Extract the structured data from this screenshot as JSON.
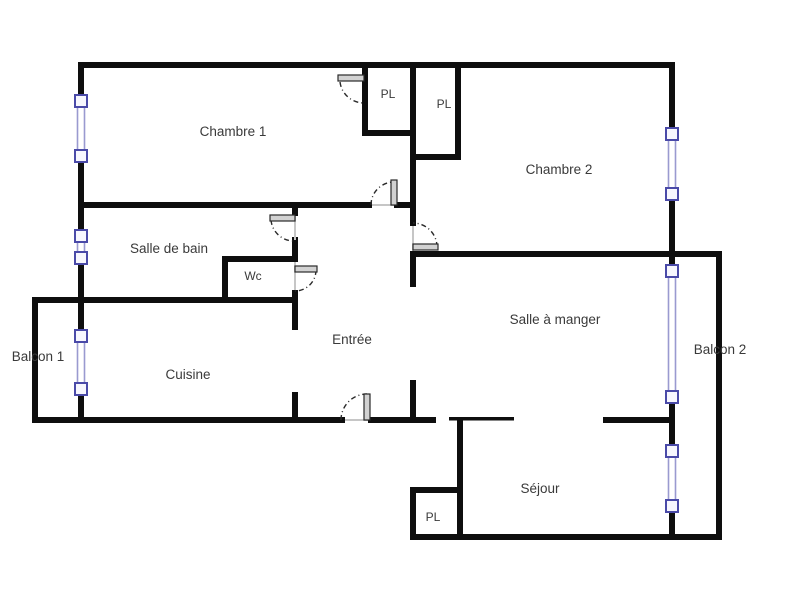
{
  "plan": {
    "type": "apartment-floor-plan",
    "language": "fr"
  },
  "colors": {
    "wall": "#0e0e0e",
    "window_frame": "#4a4aa8",
    "window_glass": "#9a9ad0",
    "window_fill": "#f7f7fe",
    "door_leaf": "#d2d2d2",
    "door_stroke": "#2a2a2a",
    "threshold": "#c6c6c6",
    "text": "#3a3a3a"
  },
  "rooms": [
    {
      "id": "chambre-1",
      "label": "Chambre 1"
    },
    {
      "id": "placard-1",
      "label": "PL"
    },
    {
      "id": "placard-2",
      "label": "PL"
    },
    {
      "id": "chambre-2",
      "label": "Chambre 2"
    },
    {
      "id": "salle-de-bain",
      "label": "Salle de bain"
    },
    {
      "id": "wc",
      "label": "Wc"
    },
    {
      "id": "entree",
      "label": "Entrée"
    },
    {
      "id": "salle-a-manger",
      "label": "Salle à manger"
    },
    {
      "id": "cuisine",
      "label": "Cuisine"
    },
    {
      "id": "balcon-1",
      "label": "Balcon 1"
    },
    {
      "id": "balcon-2",
      "label": "Balcon 2"
    },
    {
      "id": "sejour",
      "label": "Séjour"
    },
    {
      "id": "placard-3",
      "label": "PL"
    }
  ]
}
